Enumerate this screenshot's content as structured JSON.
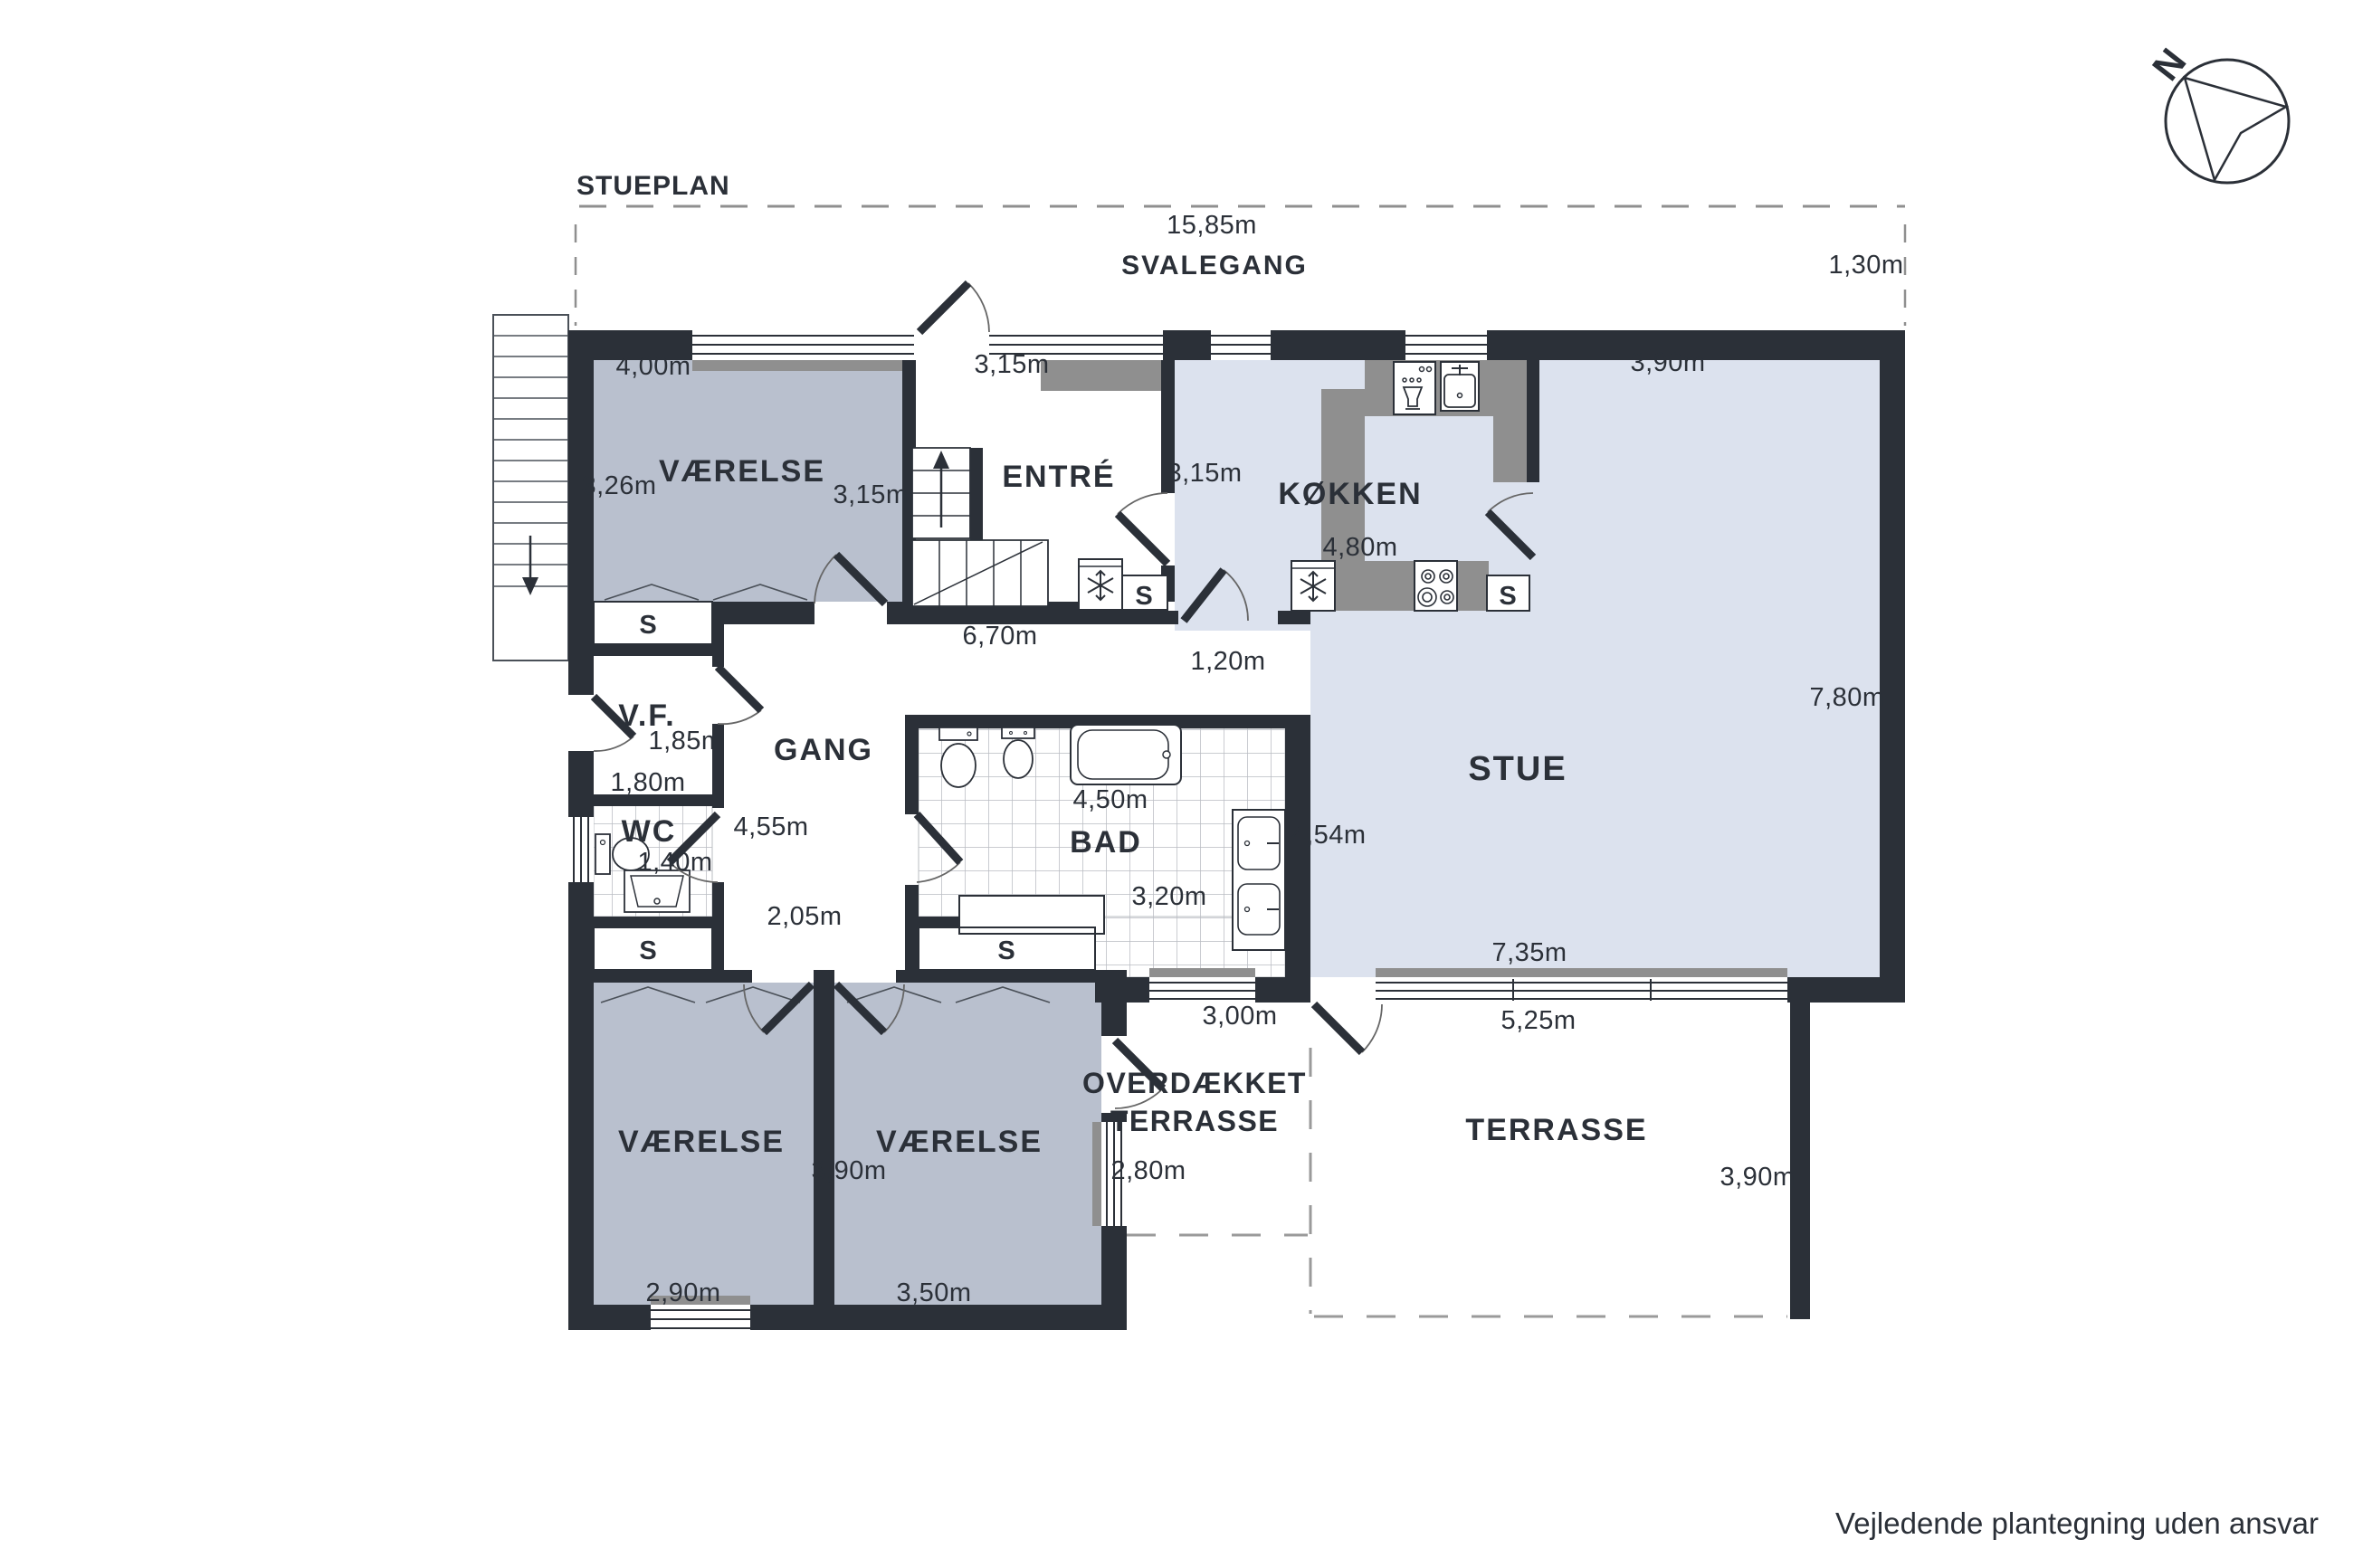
{
  "title": "STUEPLAN",
  "disclaimer": "Vejledende plantegning uden ansvar",
  "compass": {
    "north": "N"
  },
  "outside": {
    "svalegang": "SVALEGANG",
    "svalegang_len": "15,85m",
    "svalegang_w": "1,30m"
  },
  "rooms": {
    "vn": "VÆRELSE",
    "entre": "ENTRÉ",
    "kitchen": "KØKKEN",
    "stue": "STUE",
    "gang": "GANG",
    "vf": "V.F.",
    "wc": "WC",
    "bad": "BAD",
    "vsw": "VÆRELSE",
    "vs": "VÆRELSE",
    "ot1": "OVERDÆKKET",
    "ot2": "TERRASSE",
    "terrasse": "TERRASSE"
  },
  "closet": "S",
  "dims": {
    "vn_top": "4,00m",
    "vn_left": "3,26m",
    "vn_right": "3,15m",
    "entre_top": "3,15m",
    "kitchen_left": "3,15m",
    "stue_top": "3,90m",
    "counter": "4,80m",
    "gang_top": "6,70m",
    "pass": "1,20m",
    "stue_right": "7,80m",
    "vf_a": "1,85m",
    "vf_b": "1,80m",
    "gang_mid": "4,55m",
    "wc_w": "1,40m",
    "gang_bottom": "2,05m",
    "bad_top": "4,50m",
    "bad_mid": "3,20m",
    "bad_right": "4,54m",
    "stue_bottom": "7,35m",
    "bad_win": "3,00m",
    "stue_win": "5,25m",
    "v_sw": "2,90m",
    "v_mid": "3,90m",
    "v_s": "3,50m",
    "ot": "2,80m",
    "ter_right": "3,90m"
  }
}
